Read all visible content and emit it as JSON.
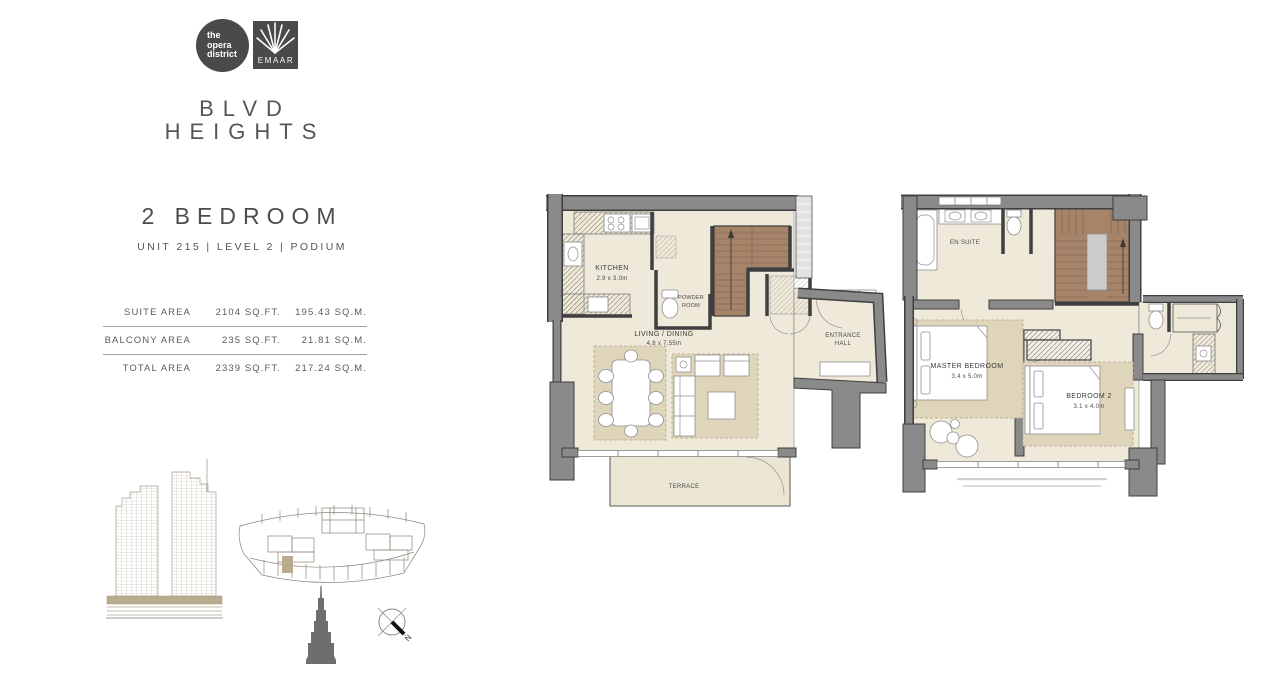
{
  "branding": {
    "opera_line1": "the",
    "opera_line2": "opera",
    "opera_line3": "district",
    "emaar": "EMAAR",
    "title_line1": "BLVD",
    "title_line2": "HEIGHTS"
  },
  "unit": {
    "type": "2 BEDROOM",
    "details": "UNIT 215  |  LEVEL 2  |  PODIUM"
  },
  "areas": {
    "rows": [
      {
        "label": "SUITE AREA",
        "sqft": "2104 SQ.FT.",
        "sqm": "195.43 SQ.M."
      },
      {
        "label": "BALCONY AREA",
        "sqft": "235 SQ.FT.",
        "sqm": "21.81 SQ.M."
      },
      {
        "label": "TOTAL AREA",
        "sqft": "2339 SQ.FT.",
        "sqm": "217.24 SQ.M."
      }
    ]
  },
  "plan_lower": {
    "kitchen_name": "KITCHEN",
    "kitchen_dims": "2.9 x 3.0m",
    "powder_line1": "POWDER",
    "powder_line2": "ROOM",
    "living_name": "LIVING / DINING",
    "living_dims": "4.8 x 7.55m",
    "entrance_line1": "ENTRANCE",
    "entrance_line2": "HALL",
    "terrace": "TERRACE"
  },
  "plan_upper": {
    "ensuite": "EN SUITE",
    "master_name": "MASTER BEDROOM",
    "master_dims": "3.4 x 5.0m",
    "bedroom2_name": "BEDROOM 2",
    "bedroom2_dims": "3.1 x 4.0m"
  },
  "compass": {
    "north": "N"
  },
  "colors": {
    "wall": "#8a8a8a",
    "wall_outline": "#3f3f3f",
    "floor": "#efe9d9",
    "rug": "#ded5ba",
    "stairs": "#a6846a",
    "accent_tan": "#b8ab8e",
    "text": "#5a5a5a",
    "logo_bg": "#4a4a4a"
  }
}
